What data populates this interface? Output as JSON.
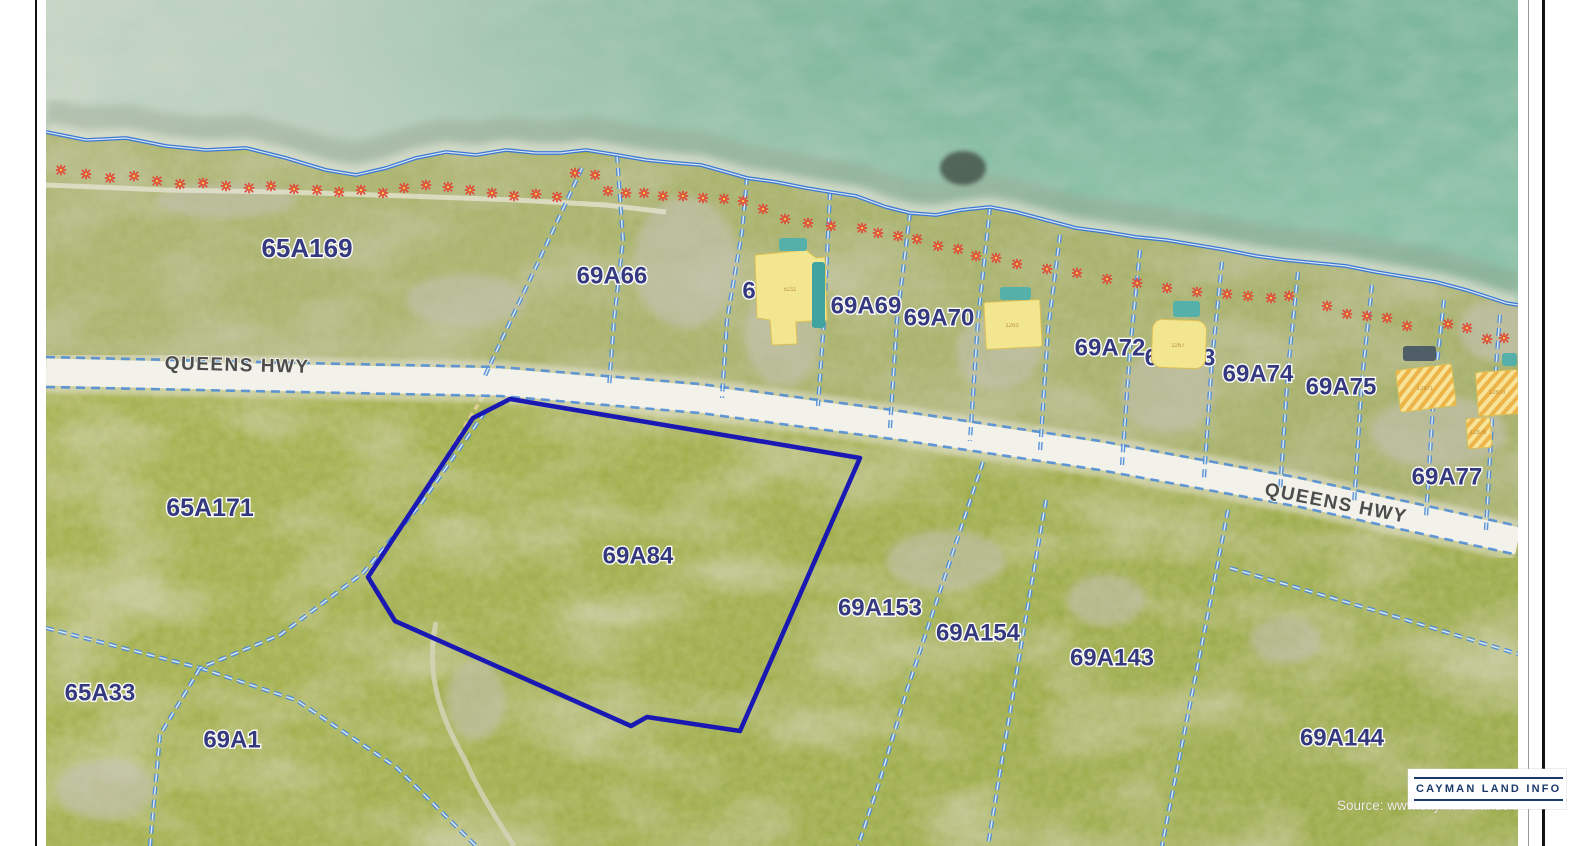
{
  "page": {
    "source_text": "Source: www.caymanislandslan",
    "logo": {
      "text": "CAYMAN LAND INFO"
    }
  },
  "map": {
    "road_labels": [
      {
        "text": "QUEENS HWY",
        "x": 191,
        "y": 371,
        "rot": 1.5
      },
      {
        "text": "QUEENS HWY",
        "x": 1289,
        "y": 509,
        "rot": 11
      }
    ],
    "parcel_labels": [
      {
        "text": "65A169",
        "x": 261,
        "y": 248,
        "s": 26
      },
      {
        "text": "69A66",
        "x": 566,
        "y": 276,
        "s": 24
      },
      {
        "text": "6",
        "x": 703,
        "y": 291,
        "s": 24
      },
      {
        "text": "69A69",
        "x": 820,
        "y": 306,
        "s": 24
      },
      {
        "text": "69A70",
        "x": 893,
        "y": 318,
        "s": 24
      },
      {
        "text": "6",
        "x": 947,
        "y": 330,
        "s": 24
      },
      {
        "text": "69A72",
        "x": 1064,
        "y": 348,
        "s": 24
      },
      {
        "text": "69A73",
        "x": 1134,
        "y": 358,
        "s": 24
      },
      {
        "text": "69A74",
        "x": 1212,
        "y": 374,
        "s": 24
      },
      {
        "text": "69A75",
        "x": 1295,
        "y": 387,
        "s": 24
      },
      {
        "text": "69A77",
        "x": 1401,
        "y": 477,
        "s": 24
      },
      {
        "text": "65A171",
        "x": 164,
        "y": 508,
        "s": 25
      },
      {
        "text": "69A84",
        "x": 592,
        "y": 556,
        "s": 24
      },
      {
        "text": "69A153",
        "x": 834,
        "y": 608,
        "s": 24
      },
      {
        "text": "69A154",
        "x": 932,
        "y": 633,
        "s": 24
      },
      {
        "text": "69A143",
        "x": 1066,
        "y": 658,
        "s": 24
      },
      {
        "text": "69A144",
        "x": 1296,
        "y": 738,
        "s": 24
      },
      {
        "text": "65A33",
        "x": 54,
        "y": 693,
        "s": 24
      },
      {
        "text": "69A1",
        "x": 186,
        "y": 740,
        "s": 24
      }
    ],
    "building_numbers": [
      {
        "text": "5211",
        "x": 744,
        "y": 291
      },
      {
        "text": "1263",
        "x": 966,
        "y": 327
      },
      {
        "text": "1267",
        "x": 1132,
        "y": 347
      },
      {
        "text": "12871",
        "x": 1379,
        "y": 390
      },
      {
        "text": "12870",
        "x": 1451,
        "y": 394
      },
      {
        "text": "12876",
        "x": 1432,
        "y": 434
      }
    ],
    "colors": {
      "highlight": "#1412b5",
      "boundary_blue": "#4a8ad8",
      "label_navy": "#31357f",
      "building_yellow": "#f3e690",
      "pool_teal": "#56b0aa",
      "marker_red": "#df4a3a",
      "road_white": "#f2f1ea"
    },
    "veg_markers": [
      [
        15,
        170
      ],
      [
        40,
        174
      ],
      [
        64,
        178
      ],
      [
        88,
        176
      ],
      [
        111,
        181
      ],
      [
        134,
        184
      ],
      [
        157,
        183
      ],
      [
        180,
        186
      ],
      [
        203,
        188
      ],
      [
        225,
        186
      ],
      [
        248,
        189
      ],
      [
        271,
        190
      ],
      [
        293,
        192
      ],
      [
        315,
        190
      ],
      [
        337,
        193
      ],
      [
        358,
        188
      ],
      [
        380,
        185
      ],
      [
        402,
        187
      ],
      [
        424,
        190
      ],
      [
        446,
        193
      ],
      [
        468,
        196
      ],
      [
        490,
        194
      ],
      [
        511,
        197
      ],
      [
        529,
        173
      ],
      [
        549,
        175
      ],
      [
        562,
        191
      ],
      [
        580,
        193
      ],
      [
        598,
        193
      ],
      [
        617,
        196
      ],
      [
        637,
        196
      ],
      [
        657,
        198
      ],
      [
        678,
        199
      ],
      [
        697,
        201
      ],
      [
        717,
        209
      ],
      [
        739,
        219
      ],
      [
        762,
        223
      ],
      [
        785,
        226
      ],
      [
        816,
        228
      ],
      [
        832,
        233
      ],
      [
        852,
        236
      ],
      [
        871,
        239
      ],
      [
        892,
        246
      ],
      [
        912,
        249
      ],
      [
        930,
        256
      ],
      [
        950,
        258
      ],
      [
        971,
        264
      ],
      [
        1001,
        269
      ],
      [
        1031,
        273
      ],
      [
        1061,
        279
      ],
      [
        1091,
        283
      ],
      [
        1121,
        288
      ],
      [
        1151,
        292
      ],
      [
        1181,
        294
      ],
      [
        1202,
        296
      ],
      [
        1225,
        298
      ],
      [
        1243,
        296
      ],
      [
        1281,
        306
      ],
      [
        1301,
        314
      ],
      [
        1321,
        316
      ],
      [
        1341,
        318
      ],
      [
        1361,
        326
      ],
      [
        1402,
        324
      ],
      [
        1421,
        328
      ],
      [
        1441,
        339
      ],
      [
        1458,
        338
      ]
    ],
    "clearings": [
      {
        "cx": 737,
        "cy": 335,
        "rx": 38,
        "ry": 52
      },
      {
        "cx": 640,
        "cy": 262,
        "rx": 52,
        "ry": 66
      },
      {
        "cx": 952,
        "cy": 352,
        "rx": 42,
        "ry": 38
      },
      {
        "cx": 1122,
        "cy": 392,
        "rx": 48,
        "ry": 42
      },
      {
        "cx": 1392,
        "cy": 432,
        "rx": 68,
        "ry": 36
      },
      {
        "cx": 1452,
        "cy": 330,
        "rx": 40,
        "ry": 30
      },
      {
        "cx": 420,
        "cy": 300,
        "rx": 60,
        "ry": 26
      },
      {
        "cx": 180,
        "cy": 200,
        "rx": 70,
        "ry": 18
      },
      {
        "cx": 900,
        "cy": 560,
        "rx": 60,
        "ry": 30
      },
      {
        "cx": 1060,
        "cy": 600,
        "rx": 40,
        "ry": 26
      },
      {
        "cx": 430,
        "cy": 700,
        "rx": 30,
        "ry": 40
      },
      {
        "cx": 60,
        "cy": 790,
        "rx": 50,
        "ry": 30
      },
      {
        "cx": 1240,
        "cy": 640,
        "rx": 36,
        "ry": 24
      }
    ],
    "buildings": [
      {
        "kind": "poly",
        "pts": "709,255 760,250 770,258 779,257 781,320 750,322 751,344 726,345 724,320 711,318"
      },
      {
        "kind": "rect",
        "x": 939,
        "y": 301,
        "w": 56,
        "h": 47,
        "rot": -3
      },
      {
        "kind": "rect",
        "x": 1106,
        "y": 320,
        "w": 54,
        "h": 48,
        "rot": 2,
        "rx": 10
      },
      {
        "kind": "hatch",
        "x": 1352,
        "y": 367,
        "w": 56,
        "h": 42,
        "rot": -7
      },
      {
        "kind": "hatch",
        "x": 1431,
        "y": 371,
        "w": 42,
        "h": 44,
        "rot": -4
      },
      {
        "kind": "hatch",
        "x": 1421,
        "y": 418,
        "w": 24,
        "h": 30,
        "rot": -4
      }
    ],
    "pools": [
      {
        "x": 766,
        "y": 262,
        "w": 13,
        "h": 66,
        "fill": "#3fa3a0"
      },
      {
        "x": 733,
        "y": 238,
        "w": 28,
        "h": 13,
        "fill": "#56b0aa"
      },
      {
        "x": 954,
        "y": 287,
        "w": 31,
        "h": 13,
        "fill": "#56b0aa"
      },
      {
        "x": 1127,
        "y": 301,
        "w": 27,
        "h": 16,
        "fill": "#56b0aa"
      },
      {
        "x": 1456,
        "y": 353,
        "w": 15,
        "h": 13,
        "fill": "#56b0aa"
      },
      {
        "x": 1357,
        "y": 346,
        "w": 33,
        "h": 15,
        "fill": "#4e5d66"
      }
    ],
    "geometry": {
      "shoreline": "M0,132 L40,140 L80,138 L120,146 L160,150 L200,148 L240,158 L280,170 L310,175 L340,168 L370,158 L400,152 L430,155 L460,150 L490,153 L514,153 L540,150 L571,155 L600,160 L630,163 L655,165 L680,172 L701,178 L730,182 L760,188 L784,192 L810,196 L840,207 L864,213 L890,215 L915,210 L944,207 L970,212 L1000,220 L1030,228 L1060,232 L1090,237 L1120,240 L1150,245 L1180,250 L1210,256 L1240,260 L1270,263 L1300,266 L1330,272 L1360,277 L1390,282 L1420,290 L1445,298 L1460,303 L1472,305",
      "land": "M0,132 L40,140 L80,138 L120,146 L160,150 L200,148 L240,158 L280,170 L310,175 L340,168 L370,158 L400,152 L430,155 L460,150 L490,153 L514,153 L540,150 L571,155 L600,160 L630,163 L655,165 L680,172 L701,178 L730,182 L760,188 L784,192 L810,196 L840,207 L864,213 L890,215 L915,210 L944,207 L970,212 L1000,220 L1030,228 L1060,232 L1090,237 L1120,240 L1150,245 L1180,250 L1210,256 L1240,260 L1270,263 L1300,266 L1330,272 L1360,277 L1390,282 L1420,290 L1445,298 L1460,303 L1472,305 L1472,846 L0,846 Z",
      "coastal_strip": "M0,357 L254,363 L454,367 L654,384 L854,411 L1054,441 L1254,478 L1472,526 L1472,305 L1445,298 L1390,282 L1330,272 L1270,263 L1210,256 L1150,245 L1090,237 L1030,228 L970,212 L944,207 L890,215 L864,213 L810,196 L784,192 L730,182 L701,178 L655,165 L600,160 L571,155 L514,153 L460,150 L400,152 L340,168 L310,175 L240,158 L160,150 L80,138 L0,132 Z",
      "road_center": "M0,372 L254,378 L454,382 L654,399 L854,426 L1054,456 L1254,493 L1472,541",
      "road_edge_top": "M0,357 L254,363 L454,367 L654,384 L854,411 L1054,441 L1254,478 L1472,526",
      "road_edge_bottom": "M0,387 L254,392 L454,396 L654,413 L854,440 L1054,470 L1254,507 L1472,555",
      "beach_track": "M0,185 L120,190 L240,192 L360,196 L470,200 L560,205 L620,212",
      "sand_track": "M437,396 L404,452 L360,520 L322,575",
      "trail": "M390,622 C378,680 398,722 420,762 C432,790 450,818 468,846",
      "highlight_points": "464,399 814,458 694,731 601,717 585,726 349,621 322,577 427,418",
      "boundaries": [
        "M536,168 L511,222 L471,307 L437,380",
        "M571,155 L577,240 L568,320 L563,388",
        "M701,177 L696,232 L681,320 L676,398",
        "M784,192 L778,320 L772,406",
        "M864,213 L851,320 L844,428",
        "M944,207 L932,320 L924,441",
        "M1014,235 L1002,330 L994,452",
        "M1094,250 L1084,350 L1076,465",
        "M1176,262 L1166,360 L1158,478",
        "M1252,272 L1242,370 L1234,492",
        "M1326,285 L1316,380 L1308,505",
        "M1398,300 L1388,390 L1380,518",
        "M1454,315 L1446,420 L1440,530",
        "M937,462 L891,600 L861,690 L834,780 L812,846",
        "M1000,500 L984,593 L951,790 L942,846",
        "M1182,510 L1166,593 L1127,790 L1116,846",
        "M1184,568 L1334,612 L1472,654",
        "M0,628 L154,668",
        "M154,668 L114,735 L104,846",
        "M154,668 L250,700 L350,767 L430,846",
        "M439,412 L374,505 L317,573 L234,635 L154,668"
      ]
    }
  }
}
